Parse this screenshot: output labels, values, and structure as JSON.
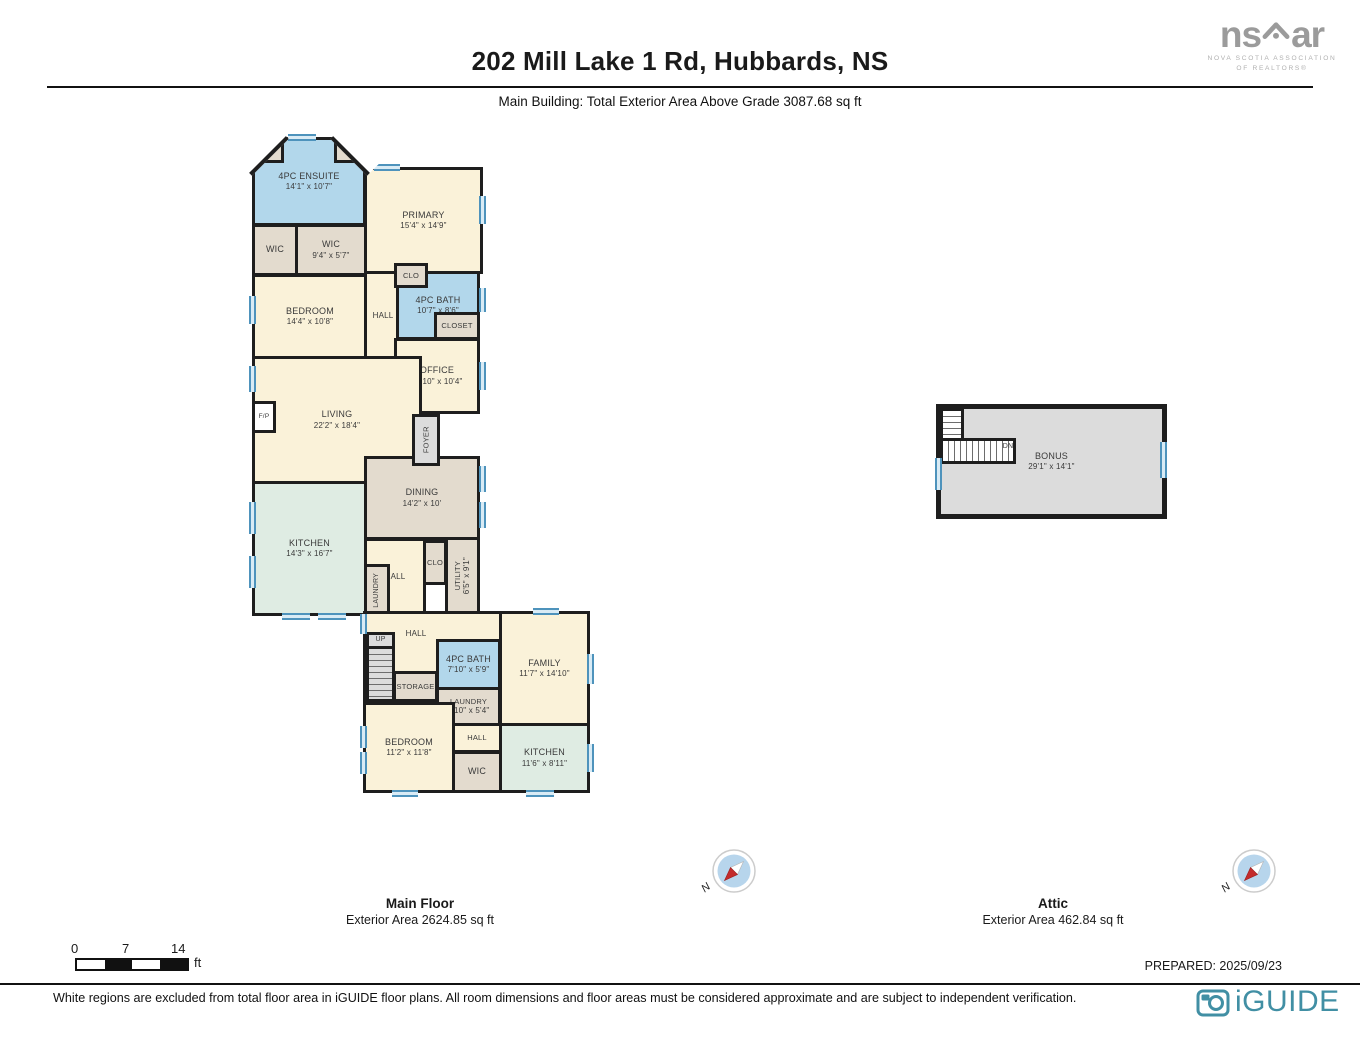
{
  "header": {
    "title": "202 Mill Lake 1 Rd, Hubbards, NS",
    "subtitle": "Main Building: Total Exterior Area Above Grade 3087.68 sq ft"
  },
  "branding": {
    "nsar_ns": "ns",
    "nsar_ar": "ar",
    "nsar_caption_line1": "NOVA SCOTIA ASSOCIATION",
    "nsar_caption_line2": "OF REALTORS®",
    "iguide": "iGUIDE"
  },
  "floors": [
    {
      "id": "main",
      "title": "Main Floor",
      "area": "Exterior Area 2624.85 sq ft"
    },
    {
      "id": "attic",
      "title": "Attic",
      "area": "Exterior Area 462.84 sq ft"
    }
  ],
  "compass_label": "N",
  "scalebar": {
    "t0": "0",
    "t1": "7",
    "t2": "14",
    "unit": "ft"
  },
  "prepared": "PREPARED: 2025/09/23",
  "disclaimer": "White regions are excluded from total floor area in iGUIDE floor plans. All room dimensions and floor areas must be considered approximate and are subject to independent verification.",
  "palette": {
    "cream": "#FAF2D9",
    "tan": "#E3DBCE",
    "blue": "#B2D7EB",
    "mint": "#DFECE3",
    "gray": "#DCDCDC",
    "white": "#FFFFFF",
    "wall": "#1E1E1E",
    "window_blue": "#4E93BC",
    "iguide_teal": "#418FA4",
    "logo_gray": "#9B9B9B"
  },
  "plan": {
    "rooms": [
      {
        "name": "4PC ENSUITE",
        "dims": "14'1\" x 10'7\"",
        "x": 252,
        "y": 137,
        "w": 114,
        "h": 89,
        "fill": "blue"
      },
      {
        "x": 254,
        "y": 139,
        "w": 30,
        "h": 24,
        "fill": "tan"
      },
      {
        "x": 334,
        "y": 139,
        "w": 30,
        "h": 24,
        "fill": "tan"
      },
      {
        "name": "PRIMARY",
        "dims": "15'4\" x 14'9\"",
        "x": 364,
        "y": 167,
        "w": 119,
        "h": 107,
        "fill": "cream"
      },
      {
        "name": "WIC",
        "x": 252,
        "y": 224,
        "w": 46,
        "h": 52,
        "fill": "tan"
      },
      {
        "name": "WIC",
        "dims": "9'4\" x 5'7\"",
        "x": 295,
        "y": 224,
        "w": 72,
        "h": 52,
        "fill": "tan"
      },
      {
        "name": "BEDROOM",
        "dims": "14'4\" x 10'8\"",
        "x": 252,
        "y": 274,
        "w": 116,
        "h": 85,
        "fill": "cream"
      },
      {
        "name": "HALL",
        "x": 364,
        "y": 271,
        "w": 38,
        "h": 89,
        "fill": "cream",
        "fs": 8
      },
      {
        "name": "4PC BATH",
        "dims": "10'7\" x 8'6\"",
        "x": 396,
        "y": 271,
        "w": 84,
        "h": 69,
        "fill": "blue"
      },
      {
        "name": "CLO",
        "x": 394,
        "y": 263,
        "w": 34,
        "h": 25,
        "fill": "tan",
        "fs": 7.5
      },
      {
        "name": "CLOSET",
        "x": 434,
        "y": 312,
        "w": 46,
        "h": 28,
        "fill": "tan",
        "fs": 7.5
      },
      {
        "name": "OFFICE",
        "dims": "10'10\" x 10'4\"",
        "x": 394,
        "y": 338,
        "w": 86,
        "h": 76,
        "fill": "cream"
      },
      {
        "name": "LIVING",
        "dims": "22'2\" x 18'4\"",
        "x": 252,
        "y": 356,
        "w": 170,
        "h": 128,
        "fill": "cream"
      },
      {
        "name": "DINING",
        "dims": "14'2\" x 10'",
        "x": 364,
        "y": 456,
        "w": 116,
        "h": 84,
        "fill": "tan"
      },
      {
        "name": "KITCHEN",
        "dims": "14'3\" x 16'7\"",
        "x": 252,
        "y": 481,
        "w": 115,
        "h": 135,
        "fill": "mint"
      },
      {
        "name": "FOYER",
        "x": 412,
        "y": 414,
        "w": 28,
        "h": 52,
        "fill": "gray",
        "v": true,
        "fs": 7.5
      },
      {
        "name": "F/P",
        "x": 252,
        "y": 401,
        "w": 24,
        "h": 32,
        "fill": "white",
        "fs": 6.5
      },
      {
        "name": "HALL",
        "x": 364,
        "y": 538,
        "w": 62,
        "h": 78,
        "fill": "cream",
        "fs": 8
      },
      {
        "name": "CLO",
        "x": 423,
        "y": 540,
        "w": 24,
        "h": 45,
        "fill": "tan",
        "fs": 7.5
      },
      {
        "name": "UTILITY",
        "dims": "6'5\" x 9'1\"",
        "x": 445,
        "y": 537,
        "w": 35,
        "h": 77,
        "fill": "tan",
        "v": true,
        "fs": 7.5
      },
      {
        "name": "LAUNDRY",
        "x": 364,
        "y": 564,
        "w": 26,
        "h": 52,
        "fill": "tan",
        "v": true,
        "fs": 7
      },
      {
        "x": 363,
        "y": 611,
        "w": 139,
        "h": 94,
        "fill": "cream"
      },
      {
        "name": "FAMILY",
        "dims": "11'7\" x 14'10\"",
        "x": 499,
        "y": 611,
        "w": 91,
        "h": 115,
        "fill": "cream"
      },
      {
        "name": "4PC BATH",
        "dims": "7'10\" x 5'9\"",
        "x": 436,
        "y": 639,
        "w": 65,
        "h": 51,
        "fill": "blue"
      },
      {
        "name": "STORAGE",
        "x": 393,
        "y": 671,
        "w": 45,
        "h": 31,
        "fill": "tan",
        "fs": 7.5
      },
      {
        "name": "LAUNDRY",
        "dims": "7'10\" x 5'4\"",
        "x": 436,
        "y": 687,
        "w": 65,
        "h": 39,
        "fill": "tan",
        "fs": 7.5
      },
      {
        "name": "BEDROOM",
        "dims": "11'2\" x 11'8\"",
        "x": 363,
        "y": 702,
        "w": 92,
        "h": 91,
        "fill": "cream"
      },
      {
        "name": "HALL",
        "x": 452,
        "y": 723,
        "w": 50,
        "h": 30,
        "fill": "cream",
        "fs": 7.5
      },
      {
        "name": "WIC",
        "x": 452,
        "y": 751,
        "w": 50,
        "h": 42,
        "fill": "tan"
      },
      {
        "name": "KITCHEN",
        "dims": "11'6\" x 8'11\"",
        "x": 499,
        "y": 723,
        "w": 91,
        "h": 70,
        "fill": "mint"
      },
      {
        "name": "UP",
        "x": 366,
        "y": 632,
        "w": 29,
        "h": 17,
        "fill": "gray",
        "fs": 7
      },
      {
        "x": 366,
        "y": 646,
        "w": 29,
        "h": 56,
        "fill": "gray",
        "stairs": "h"
      },
      {
        "name": "HALL",
        "x": 394,
        "y": 626,
        "w": 44,
        "h": 16,
        "fill": "none",
        "fs": 8
      },
      {
        "name": "BONUS",
        "dims": "29'1\" x 14'1\"",
        "x": 938,
        "y": 406,
        "w": 227,
        "h": 111,
        "fill": "gray",
        "shadow": true
      },
      {
        "x": 940,
        "y": 408,
        "w": 24,
        "h": 33,
        "fill": "white",
        "stairs": "h"
      },
      {
        "x": 940,
        "y": 438,
        "w": 76,
        "h": 26,
        "fill": "white",
        "stairs": "v"
      },
      {
        "name": "DN",
        "x": 996,
        "y": 440,
        "w": 24,
        "h": 14,
        "fill": "none",
        "fs": 7
      }
    ],
    "windows": [
      {
        "x": 288,
        "y": 134,
        "w": 28,
        "h": 7
      },
      {
        "x": 374,
        "y": 164,
        "w": 26,
        "h": 7
      },
      {
        "x": 479,
        "y": 196,
        "w": 7,
        "h": 28
      },
      {
        "x": 479,
        "y": 288,
        "w": 7,
        "h": 24
      },
      {
        "x": 479,
        "y": 362,
        "w": 7,
        "h": 28
      },
      {
        "x": 479,
        "y": 466,
        "w": 7,
        "h": 26
      },
      {
        "x": 479,
        "y": 502,
        "w": 7,
        "h": 26
      },
      {
        "x": 249,
        "y": 296,
        "w": 7,
        "h": 28
      },
      {
        "x": 249,
        "y": 366,
        "w": 7,
        "h": 26
      },
      {
        "x": 249,
        "y": 502,
        "w": 7,
        "h": 32
      },
      {
        "x": 249,
        "y": 556,
        "w": 7,
        "h": 32
      },
      {
        "x": 282,
        "y": 613,
        "w": 28,
        "h": 7
      },
      {
        "x": 318,
        "y": 613,
        "w": 28,
        "h": 7
      },
      {
        "x": 360,
        "y": 614,
        "w": 7,
        "h": 20
      },
      {
        "x": 360,
        "y": 726,
        "w": 7,
        "h": 22
      },
      {
        "x": 360,
        "y": 752,
        "w": 7,
        "h": 22
      },
      {
        "x": 392,
        "y": 790,
        "w": 26,
        "h": 7
      },
      {
        "x": 526,
        "y": 790,
        "w": 28,
        "h": 7
      },
      {
        "x": 587,
        "y": 744,
        "w": 7,
        "h": 28
      },
      {
        "x": 587,
        "y": 654,
        "w": 7,
        "h": 30
      },
      {
        "x": 533,
        "y": 608,
        "w": 26,
        "h": 7
      },
      {
        "x": 250,
        "y": 150,
        "w": 20,
        "h": 5,
        "rot": -45
      },
      {
        "x": 344,
        "y": 150,
        "w": 20,
        "h": 5,
        "rot": 45
      },
      {
        "x": 935,
        "y": 458,
        "w": 7,
        "h": 32
      },
      {
        "x": 1160,
        "y": 442,
        "w": 7,
        "h": 36
      }
    ],
    "chamfers": [
      {
        "x": 233,
        "y": 130,
        "w": 52,
        "h": 28,
        "rot": -45
      },
      {
        "x": 334,
        "y": 130,
        "w": 52,
        "h": 28,
        "rot": 45
      }
    ]
  }
}
